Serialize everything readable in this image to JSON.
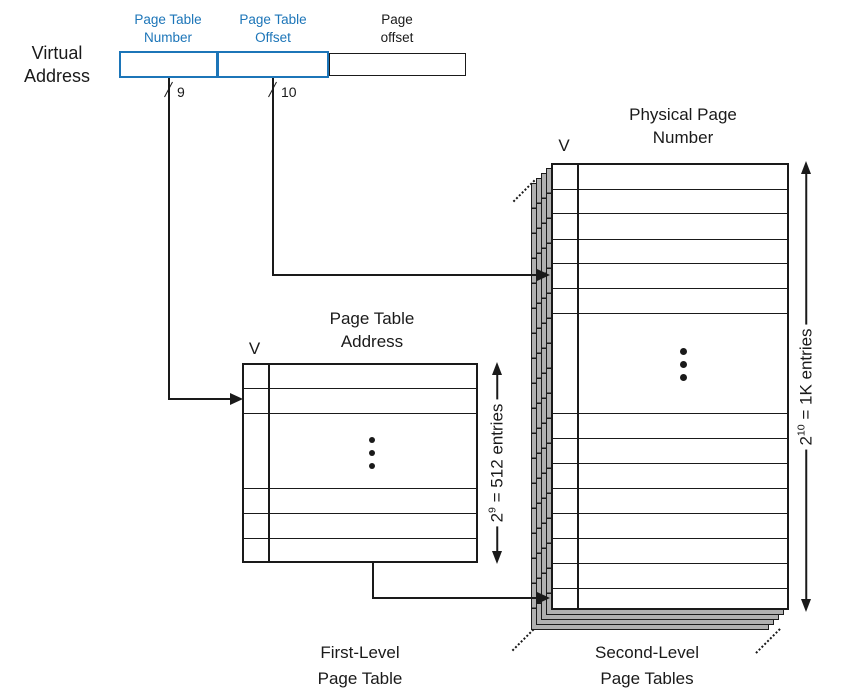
{
  "colors": {
    "accent_blue": "#1c75b8",
    "line_black": "#1a1a1a",
    "stack_gray": "#b0b0b0"
  },
  "icons": {
    "vertical_ellipsis": "⋮",
    "stack_continuation": "dotted-diagonal"
  },
  "virtual_address": {
    "label": [
      "Virtual",
      "Address"
    ],
    "fields": [
      {
        "label": [
          "Page Table",
          "Number"
        ],
        "bits": "9"
      },
      {
        "label": [
          "Page Table",
          "Offset"
        ],
        "bits": "10"
      },
      {
        "label": [
          "Page",
          "offset"
        ]
      }
    ]
  },
  "first_level": {
    "column_v": "V",
    "header": [
      "Page Table",
      "Address"
    ],
    "entries": {
      "base": "2",
      "exponent": "9",
      "suffix": " = 512 entries"
    },
    "caption": [
      "First-Level",
      "Page Table"
    ]
  },
  "second_level": {
    "column_v": "V",
    "header": [
      "Physical Page",
      "Number"
    ],
    "entries": {
      "base": "2",
      "exponent": "10",
      "suffix": " = 1K entries"
    },
    "caption": [
      "Second-Level",
      "Page Tables"
    ]
  }
}
